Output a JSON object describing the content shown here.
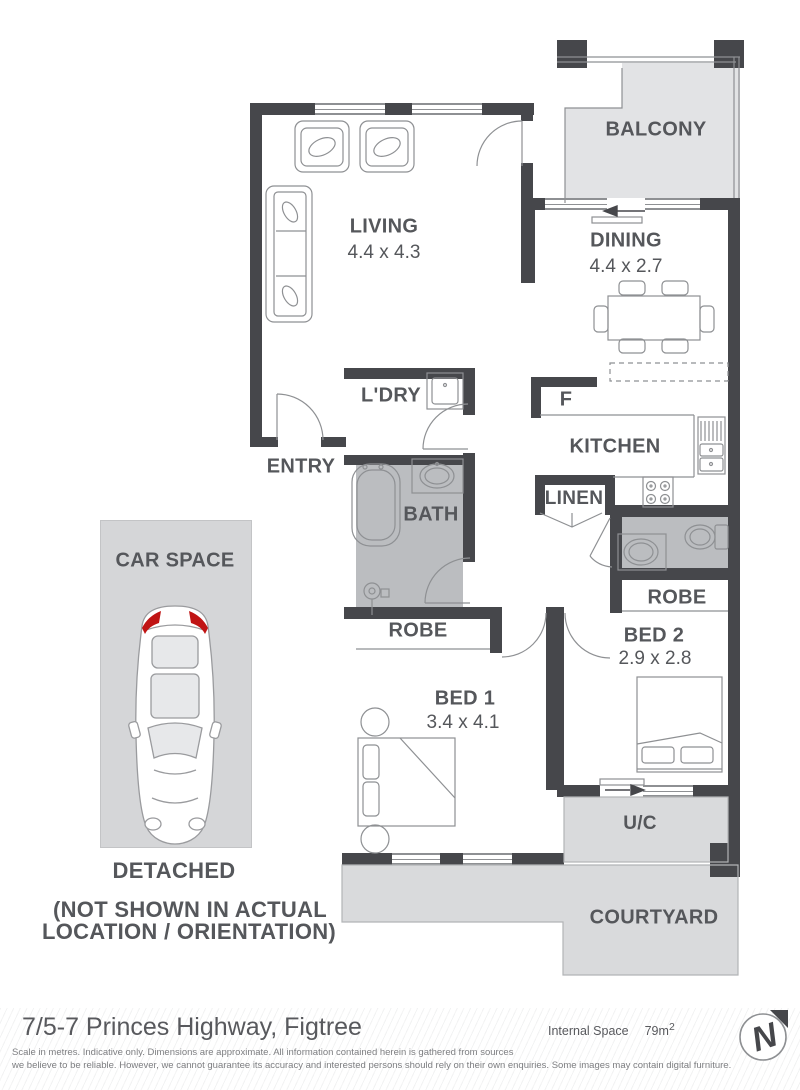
{
  "plan": {
    "balcony": "BALCONY",
    "living": "LIVING",
    "living_dims": "4.4 x 4.3",
    "dining": "DINING",
    "dining_dims": "4.4 x 2.7",
    "laundry": "L'DRY",
    "entry": "ENTRY",
    "kitchen": "KITCHEN",
    "fridge": "F",
    "bath": "BATH",
    "linen": "LINEN",
    "robe_bed1": "ROBE",
    "robe_bed2": "ROBE",
    "bed1": "BED 1",
    "bed1_dims": "3.4 x 4.1",
    "bed2": "BED 2",
    "bed2_dims": "2.9 x 2.8",
    "uc": "U/C",
    "courtyard": "COURTYARD",
    "car_space": "CAR SPACE",
    "detached": "DETACHED",
    "note_line1": "(NOT SHOWN IN ACTUAL",
    "note_line2": "LOCATION / ORIENTATION)"
  },
  "footer": {
    "address": "7/5-7 Princes Highway, Figtree",
    "internal_space_label": "Internal Space",
    "internal_space_value": "79m",
    "internal_space_superscript": "2",
    "disclaimer_line1": "Scale in metres. Indicative only. Dimensions are approximate. All information contained herein is gathered from sources",
    "disclaimer_line2": "we believe to be reliable. However, we cannot guarantee its accuracy and interested persons should rely on their own enquiries. Some images may contain digital furniture."
  },
  "compass": {
    "letter": "N"
  },
  "colors": {
    "wall": "#46474b",
    "label": "#55575b",
    "balcony_fill": "#e2e3e5",
    "outdoor_fill": "#d9dadc",
    "carspace_fill": "#d5d6d8",
    "wet_area_fill": "#bbbdc0",
    "line": "#8e9093",
    "tail_light_red": "#c01414"
  }
}
